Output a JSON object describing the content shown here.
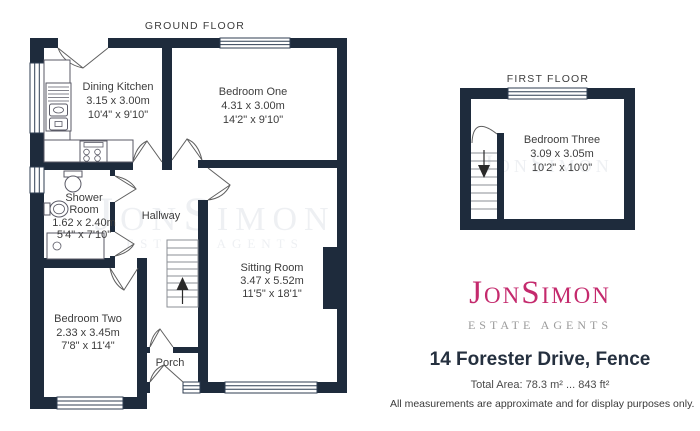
{
  "colors": {
    "wall": "#1e2b3c",
    "label": "#3d3d3d",
    "line": "#2f3e52",
    "logo_pink": "#c42a6d",
    "tagline_gray": "#9b9b9b",
    "address": "#25303f"
  },
  "ground_floor": {
    "title": "GROUND FLOOR",
    "dining_kitchen": {
      "name": "Dining Kitchen",
      "metric": "3.15 x 3.00m",
      "imperial": "10'4\" x 9'10\""
    },
    "bedroom_one": {
      "name": "Bedroom One",
      "metric": "4.31 x 3.00m",
      "imperial": "14'2\" x 9'10\""
    },
    "shower_room": {
      "name_line_1": "Shower",
      "name_line_2": "Room",
      "metric": "1.62 x 2.40m",
      "imperial": "5'4\" x 7'10\""
    },
    "hallway": {
      "name": "Hallway"
    },
    "bedroom_two": {
      "name": "Bedroom Two",
      "metric": "2.33 x 3.45m",
      "imperial": "7'8\" x 11'4\""
    },
    "porch": {
      "name": "Porch"
    },
    "sitting_room": {
      "name": "Sitting Room",
      "metric": "3.47 x 5.52m",
      "imperial": "11'5\" x 18'1\""
    }
  },
  "first_floor": {
    "title": "FIRST FLOOR",
    "bedroom_three": {
      "name": "Bedroom Three",
      "metric": "3.09 x 3.05m",
      "imperial": "10'2\" x 10'0\""
    }
  },
  "watermark": {
    "name": "JonSimon",
    "tagline": "ESTATE AGENTS"
  },
  "branding": {
    "logo": {
      "part1": "J",
      "part2": "ON",
      "part3": "S",
      "part4": "IMON"
    },
    "tagline": "ESTATE AGENTS",
    "address": "14 Forester Drive, Fence",
    "total_area": "Total Area: 78.3 m² ... 843 ft²",
    "disclaimer": "All measurements are approximate and for display purposes only."
  }
}
